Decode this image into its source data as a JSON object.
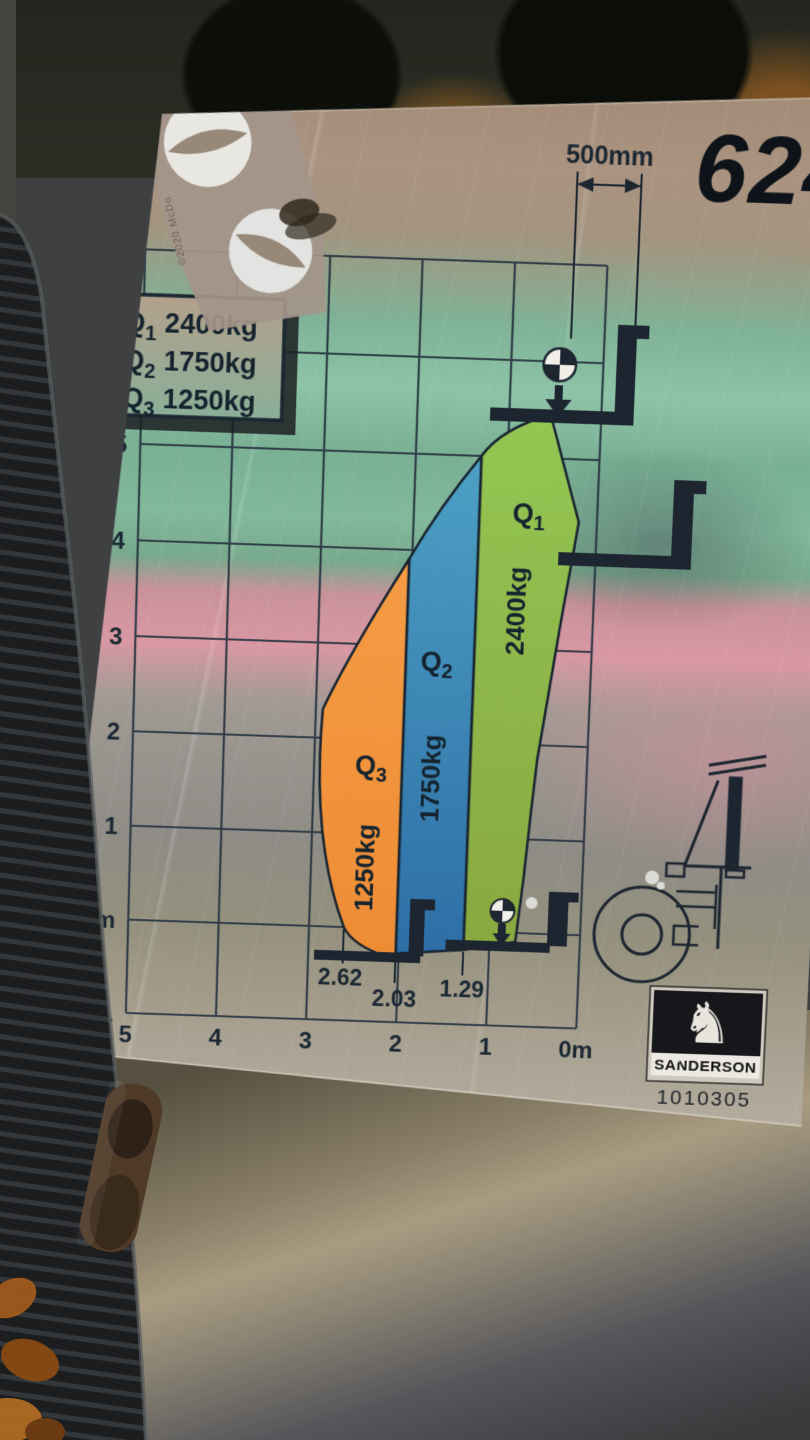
{
  "plate": {
    "model_number": "624",
    "load_center": {
      "label": "500mm"
    },
    "legend": {
      "rows": [
        {
          "name": "Q",
          "sub": "1",
          "capacity": "2400kg"
        },
        {
          "name": "Q",
          "sub": "2",
          "capacity": "1750kg"
        },
        {
          "name": "Q",
          "sub": "3",
          "capacity": "1250kg"
        }
      ]
    },
    "zones": [
      {
        "name": "Q",
        "sub": "1",
        "capacity": "2400kg",
        "color": "#8abc4d"
      },
      {
        "name": "Q",
        "sub": "2",
        "capacity": "1750kg",
        "color": "#2f7fb3"
      },
      {
        "name": "Q",
        "sub": "3",
        "capacity": "1250kg",
        "color": "#ef943e"
      }
    ],
    "y_axis": {
      "labels": [
        "7",
        "6",
        "5",
        "4",
        "3",
        "2",
        "1",
        "0m",
        "-1"
      ]
    },
    "x_axis": {
      "labels": [
        "5",
        "4",
        "3",
        "2",
        "1",
        "0m"
      ]
    },
    "reach_marks": [
      "2.62",
      "2.03",
      "1.29"
    ],
    "brand": "SANDERSON",
    "part_number": "1010305",
    "sticker": {
      "small_text": "©2020 McDo"
    }
  },
  "chart_data": {
    "type": "area",
    "title": "Sanderson 624 telehandler load capacity chart",
    "x_axis": {
      "label": "reach (m)",
      "ticks": [
        "5",
        "4",
        "3",
        "2",
        "1",
        "0m"
      ],
      "reversed": true,
      "range": [
        0,
        5
      ]
    },
    "y_axis": {
      "label": "lift height (m)",
      "ticks": [
        "7",
        "6",
        "5",
        "4",
        "3",
        "2",
        "1",
        "0m",
        "-1"
      ],
      "range": [
        -1,
        7
      ]
    },
    "grid": true,
    "load_center_mm": 500,
    "zones": [
      {
        "id": "Q1",
        "capacity_kg": 2400,
        "reach_boundary_m": 1.29,
        "max_height_m": 5.5,
        "color": "#8abc4d"
      },
      {
        "id": "Q2",
        "capacity_kg": 1750,
        "reach_boundary_m": 2.03,
        "max_height_m": 5.0,
        "color": "#2f7fb3"
      },
      {
        "id": "Q3",
        "capacity_kg": 1250,
        "reach_boundary_m": 2.62,
        "max_height_m": 3.9,
        "color": "#ef943e"
      }
    ],
    "reach_marks_m": [
      2.62,
      2.03,
      1.29
    ]
  },
  "colors": {
    "zone_q1": "#8abc4d",
    "zone_q2": "#2f7fb3",
    "zone_q3": "#ef943e",
    "line_ink": "#182430",
    "plate_teal_reflection": "#7fb296",
    "plate_pink_reflection": "#d898a4",
    "plate_tan": "#a28a75"
  }
}
